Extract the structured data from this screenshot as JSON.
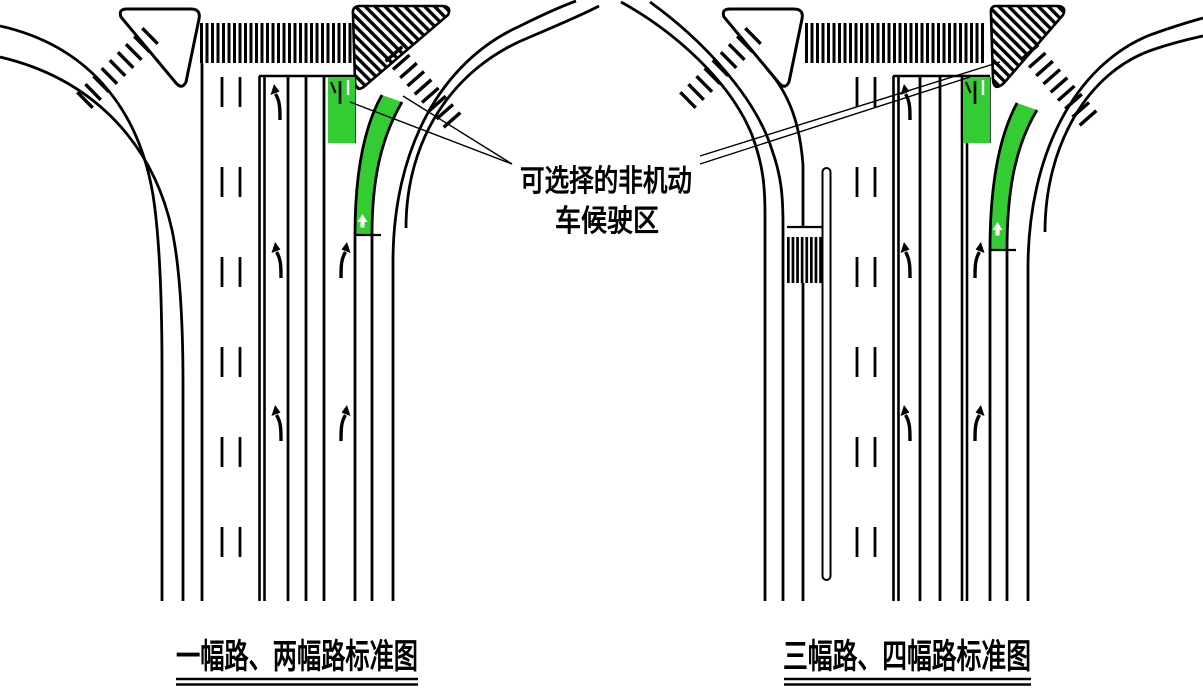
{
  "annotation": {
    "line1": "可选择的非机动",
    "line2": "车候驶区"
  },
  "captions": {
    "left": "一幅路、两幅路标准图",
    "right": "三幅路、四幅路标准图"
  },
  "colors": {
    "waiting_zone_green": "#33CC33",
    "line_black": "#000000",
    "background": "#FFFFFF"
  }
}
